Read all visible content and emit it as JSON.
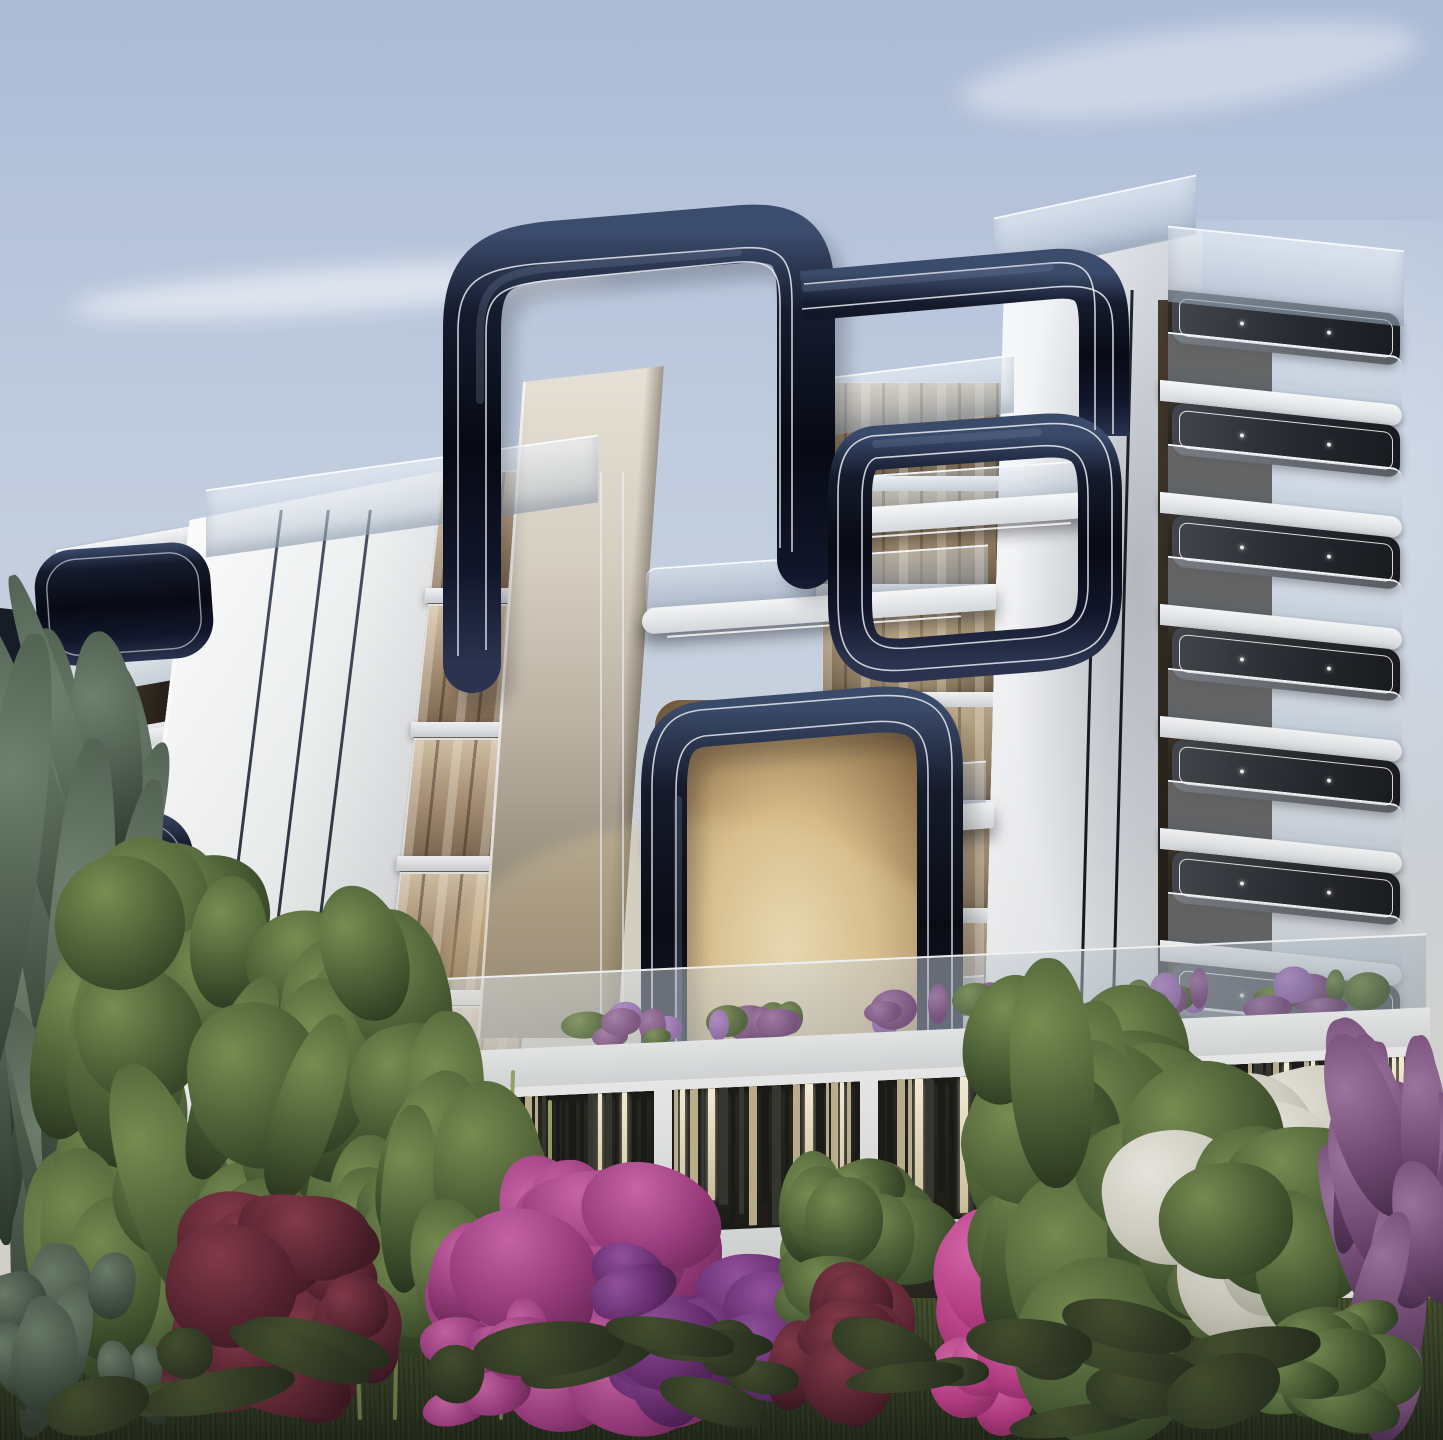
{
  "meta": {
    "title": "Dusk 3D architectural render – modern curved-ribbon apartment complex with landscaped garden",
    "width_px": 1443,
    "height_px": 1440,
    "visible_text": "none"
  },
  "palette": {
    "sky_top": "#aebdd8",
    "sky_mid": "#c9d3e2",
    "sky_horizon": "#dcdcd6",
    "cloud": "#f0f3f7",
    "facade_white": "#f3f4f6",
    "facade_bright": "#fdfdfe",
    "facade_shade": "#c7ccd2",
    "facade_groove": "#343b4a",
    "cream_light": "#e6e0d5",
    "cream_dark": "#756d60",
    "ribbon_dark": "#0b0e1b",
    "ribbon_mid": "#1c2336",
    "ribbon_hilite": "#3a4a6b",
    "pinstripe": "#eceef2",
    "glass_light": "#e2eaf3",
    "glass_dark": "#94a4b8",
    "window_dark": "#241f19",
    "window_warm": "#6e5138",
    "interior_bright": "#f0e3c0",
    "interior_amber": "#c8a474",
    "interior_shadow": "#5f4c36",
    "soffit": "#2a2d33",
    "led": "rgba(255,255,255,0.85)",
    "slat_bg": "#201f1a",
    "slat_dark": "#171814",
    "slat_lit_a": "#fdf7e0",
    "slat_lit_b": "#d5c9a2",
    "slat_cream": "#c0b492",
    "grass_light": "#46522f",
    "grass_mid": "#333d26",
    "grass_dark": "#232b1c",
    "leaf_light": "#7b9154",
    "leaf_mid": "#4c6136",
    "leaf_dark": "#26331d",
    "conifer_light": "#6f8270",
    "conifer_mid": "#49594b",
    "conifer_dark": "#2a362c",
    "magenta_light": "#d268ae",
    "magenta_mid": "#a23d86",
    "magenta_dark": "#63214f",
    "purple_light": "#9a55a8",
    "purple_mid": "#6f2f7a",
    "purple_dark": "#3f1747",
    "pink_light": "#e26cb4",
    "pink_mid": "#c4408f",
    "pink_dark": "#7e2459",
    "burgundy_light": "#8a3a4e",
    "burgundy_mid": "#5e2433",
    "burgundy_dark": "#33121d",
    "blossom_light": "#f2f1ea",
    "blossom_mid": "#d8d7ca",
    "blossom_shadow": "#a9aa9b",
    "violet_light": "#a077a6",
    "violet_mid": "#744a78",
    "violet_dark": "#452a4c",
    "trunk": "#7d6c58",
    "stem_green": "#9aa86a"
  },
  "scene": {
    "sky": {
      "clouds": [
        {
          "x": 70,
          "y": 268,
          "w": 540,
          "h": 44,
          "rot": -4,
          "opacity": 0.55
        },
        {
          "x": 960,
          "y": 30,
          "w": 460,
          "h": 80,
          "rot": -7,
          "opacity": 0.4
        },
        {
          "x": -60,
          "y": 1010,
          "w": 300,
          "h": 190,
          "rot": 0,
          "opacity": 0.45
        }
      ]
    },
    "building": {
      "left_wing": {
        "floor_count": 6
      },
      "fin_wall": {
        "groove_count": 3,
        "groove_pos": [
          34,
          52,
          68
        ]
      },
      "glass_tower": {
        "floor_count": 5
      },
      "center_block": {
        "floor_count": 6,
        "lit_levels": [
          0.15,
          0.25,
          0.5,
          0.95,
          0.85,
          0.4
        ]
      },
      "right_tower": {
        "pinstripe_count": 2,
        "pinstripe_pos": [
          48,
          64
        ],
        "balcony_count": 7
      },
      "ribbons": {
        "count": 5,
        "style": "glossy navy loops with twin white pinstripes"
      },
      "mini_balconies": [
        {
          "x": 846,
          "y": 468,
          "w": 250,
          "h": 66
        },
        {
          "x": 646,
          "y": 556,
          "w": 350,
          "h": 74
        },
        {
          "x": 650,
          "y": 772,
          "w": 344,
          "h": 76
        },
        {
          "x": 656,
          "y": 986,
          "w": 336,
          "h": 74
        }
      ],
      "podium": {
        "terrace_planters": [
          {
            "x": 312,
            "w": 96
          },
          {
            "x": 556,
            "w": 130
          },
          {
            "x": 706,
            "w": 108
          },
          {
            "x": 862,
            "w": 190
          },
          {
            "x": 1118,
            "w": 104
          },
          {
            "x": 1240,
            "w": 170
          }
        ],
        "slat_bays": [
          {
            "x": 14,
            "w": 212,
            "seed": 21
          },
          {
            "x": 246,
            "w": 176,
            "seed": 22
          },
          {
            "x": 440,
            "w": 188,
            "seed": 23
          },
          {
            "x": 646,
            "w": 286,
            "seed": 24
          },
          {
            "x": 950,
            "w": 232,
            "seed": 25
          }
        ],
        "openings": [
          {
            "x": 40,
            "w": 150,
            "h": 86,
            "tone": "dark"
          },
          {
            "x": 250,
            "w": 150,
            "h": 92,
            "tone": "green"
          },
          {
            "x": 700,
            "w": 250,
            "h": 80,
            "tone": "dark"
          }
        ]
      }
    },
    "vegetation": {
      "items": [
        {
          "name": "conifer-tree-far-left",
          "box": [
            -40,
            556,
            200,
            900
          ],
          "kind": "conifer",
          "blobs": 30,
          "seed": 1
        },
        {
          "name": "leafy-tree-left",
          "box": [
            30,
            830,
            250,
            570
          ],
          "kind": "leaf",
          "blobs": 22,
          "seed": 2
        },
        {
          "name": "leafy-tree-left-2",
          "box": [
            180,
            880,
            270,
            530
          ],
          "kind": "leaf",
          "blobs": 20,
          "seed": 3
        },
        {
          "name": "slim-tree-center-left",
          "box": [
            326,
            1000,
            230,
            420
          ],
          "kind": "leaf",
          "blobs": 18,
          "seed": 4
        },
        {
          "name": "burgundy-bush-left",
          "box": [
            140,
            1190,
            270,
            250
          ],
          "kind": "burgundy",
          "blobs": 18,
          "seed": 5
        },
        {
          "name": "magenta-bougainvillea-center",
          "box": [
            420,
            1150,
            310,
            290
          ],
          "kind": "magenta",
          "blobs": 24,
          "seed": 6
        },
        {
          "name": "purple-bougainvillea-center",
          "box": [
            590,
            1240,
            230,
            200
          ],
          "kind": "purple",
          "blobs": 16,
          "seed": 7
        },
        {
          "name": "green-bush-center",
          "box": [
            770,
            1140,
            210,
            230
          ],
          "kind": "leaf",
          "blobs": 16,
          "seed": 8
        },
        {
          "name": "burgundy-bush-center",
          "box": [
            750,
            1230,
            180,
            200
          ],
          "kind": "burgundy",
          "blobs": 12,
          "seed": 9
        },
        {
          "name": "hot-pink-bush",
          "box": [
            920,
            1150,
            240,
            290
          ],
          "kind": "pink",
          "blobs": 18,
          "seed": 10
        },
        {
          "name": "tall-tree-center-right",
          "box": [
            940,
            940,
            340,
            510
          ],
          "kind": "leaf",
          "blobs": 28,
          "seed": 11
        },
        {
          "name": "white-flower-tree",
          "box": [
            1080,
            1060,
            330,
            350
          ],
          "kind": "blossom",
          "blobs": 26,
          "seed": 12
        },
        {
          "name": "violet-tree-right",
          "box": [
            1330,
            1000,
            130,
            450
          ],
          "kind": "violet",
          "blobs": 18,
          "seed": 13
        },
        {
          "name": "green-shrub-right",
          "box": [
            1240,
            1270,
            210,
            170
          ],
          "kind": "leaf",
          "blobs": 12,
          "seed": 14
        },
        {
          "name": "green-shrub-left-edge",
          "box": [
            -20,
            1240,
            200,
            200
          ],
          "kind": "conifer",
          "blobs": 14,
          "seed": 15
        },
        {
          "name": "small-pink-bush-left",
          "box": [
            420,
            1290,
            140,
            150
          ],
          "kind": "magenta",
          "blobs": 10,
          "seed": 16
        },
        {
          "name": "grass-tufts",
          "box": [
            0,
            1300,
            1443,
            140
          ],
          "kind": "tuft",
          "blobs": 26,
          "seed": 17
        }
      ],
      "stems": [
        {
          "x": 352,
          "y": 1080,
          "h": 340,
          "lean": -2
        },
        {
          "x": 396,
          "y": 1060,
          "h": 360,
          "lean": 1
        },
        {
          "x": 448,
          "y": 1090,
          "h": 330,
          "lean": -1
        },
        {
          "x": 505,
          "y": 1070,
          "h": 350,
          "lean": 2
        },
        {
          "x": 548,
          "y": 1100,
          "h": 320,
          "lean": 0
        }
      ],
      "trunks": [
        {
          "x": 1196,
          "y": 1390,
          "len": 170,
          "rot": -28
        },
        {
          "x": 1210,
          "y": 1395,
          "len": 180,
          "rot": -10
        },
        {
          "x": 1222,
          "y": 1395,
          "len": 175,
          "rot": 8
        },
        {
          "x": 1236,
          "y": 1390,
          "len": 165,
          "rot": 26
        }
      ]
    }
  }
}
